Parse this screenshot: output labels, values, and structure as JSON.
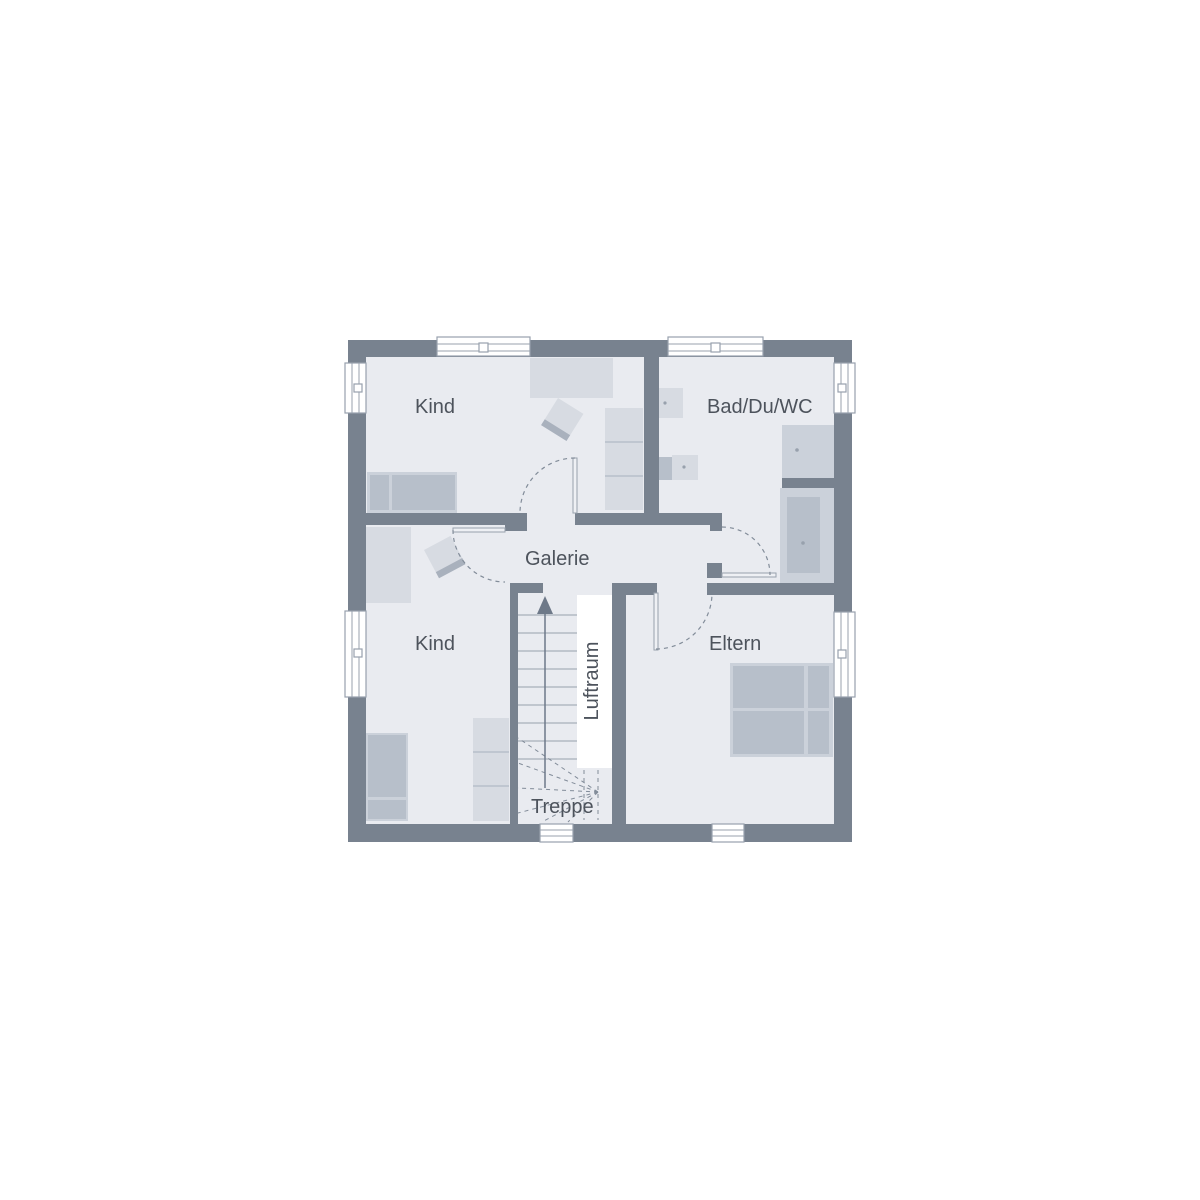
{
  "plan": {
    "labels": {
      "room_kind_top": "Kind",
      "room_bad": "Bad/Du/WC",
      "room_galerie": "Galerie",
      "room_kind_bottom": "Kind",
      "room_eltern": "Eltern",
      "luftraum": "Luftraum",
      "treppe": "Treppe"
    },
    "colors": {
      "wall": "#78828f",
      "floor": "#e9ebf0",
      "furniture_light": "#d7dbe2",
      "furniture_mid": "#cbd1da",
      "furniture_dark": "#b7bfca",
      "furniture_strip": "#a9b1bd",
      "line": "#98a1ad",
      "dash": "#828c99",
      "text": "#4d535c",
      "arrow": "#6e7989",
      "background": "#ffffff"
    }
  }
}
